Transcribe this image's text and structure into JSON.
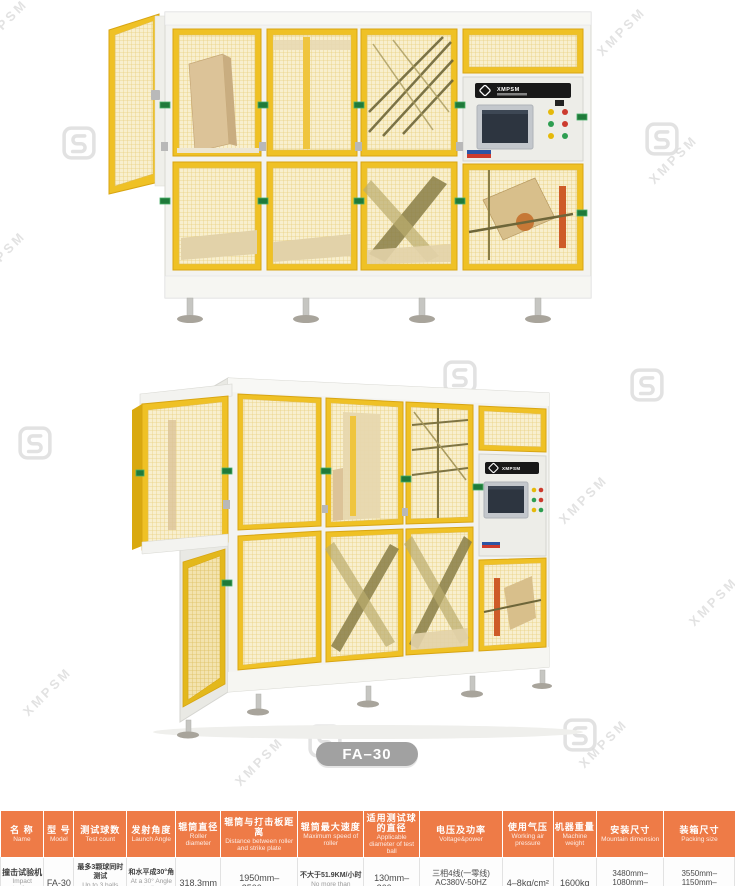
{
  "watermark": {
    "text": "XMPSM",
    "logo": "S-ribbon-logo"
  },
  "machines": {
    "panel_brand": "XMPSM",
    "front_view": "impact-testing-machine-front-view-photo",
    "side_view": "impact-testing-machine-perspective-view-photo"
  },
  "model_badge": "FA–30",
  "colors": {
    "header_orange": "#ee7b47",
    "machine_yellow": "#efc125",
    "badge_gray": "#a1a1a1",
    "clip_green": "#1f7a3a",
    "watermark_gray": "#dbdbdb"
  },
  "spec_table": {
    "columns": [
      {
        "zh": "名 称",
        "en": "Name"
      },
      {
        "zh": "型 号",
        "en": "Model"
      },
      {
        "zh": "测试球数",
        "en": "Test count"
      },
      {
        "zh": "发射角度",
        "en": "Launch Angle"
      },
      {
        "zh": "辊筒直径",
        "en": "Roller diameter"
      },
      {
        "zh": "辊筒与打击板距离",
        "en": "Distance between roller and strike plate"
      },
      {
        "zh": "辊筒最大速度",
        "en": "Maximum speed of roller"
      },
      {
        "zh": "适用测试球的直径",
        "en": "Applicable diameter of test ball"
      },
      {
        "zh": "电压及功率",
        "en": "Voltage&power"
      },
      {
        "zh": "使用气压",
        "en": "Working air pressure"
      },
      {
        "zh": "机器重量",
        "en": "Machine weight"
      },
      {
        "zh": "安装尺寸",
        "en": "Mountain dimension"
      },
      {
        "zh": "装箱尺寸",
        "en": "Packing size"
      }
    ],
    "row": {
      "name_zh": "撞击试验机",
      "name_en": "Impact testing machine",
      "model": "FA-30",
      "test_count_zh": "最多3颗球同时测试",
      "test_count_en": "Up to 3 balls tested at the same time",
      "launch_angle_zh": "和水平成30°角",
      "launch_angle_en": "At a 30° Angle to the horizontal",
      "roller_diameter": "318.3mm",
      "roller_strike_distance": "1950mm–2500mm",
      "max_speed_zh": "不大于51.9KM/小时",
      "max_speed_en": "No more than 51.9km/h",
      "ball_diameter": "130mm–260mm",
      "voltage_line1": "三相4线(一零线)",
      "voltage_line2": "AC380V-50HZ",
      "voltage_line3": "2.5KW",
      "air_pressure": "4–8kg/cm²",
      "weight": "1600kg",
      "mount_line1": "3480mm–1080mm–",
      "mount_line2": "H 2322mm",
      "packing_line1": "3550mm–1150mm–",
      "packing_line2": "H 2480mm"
    }
  }
}
